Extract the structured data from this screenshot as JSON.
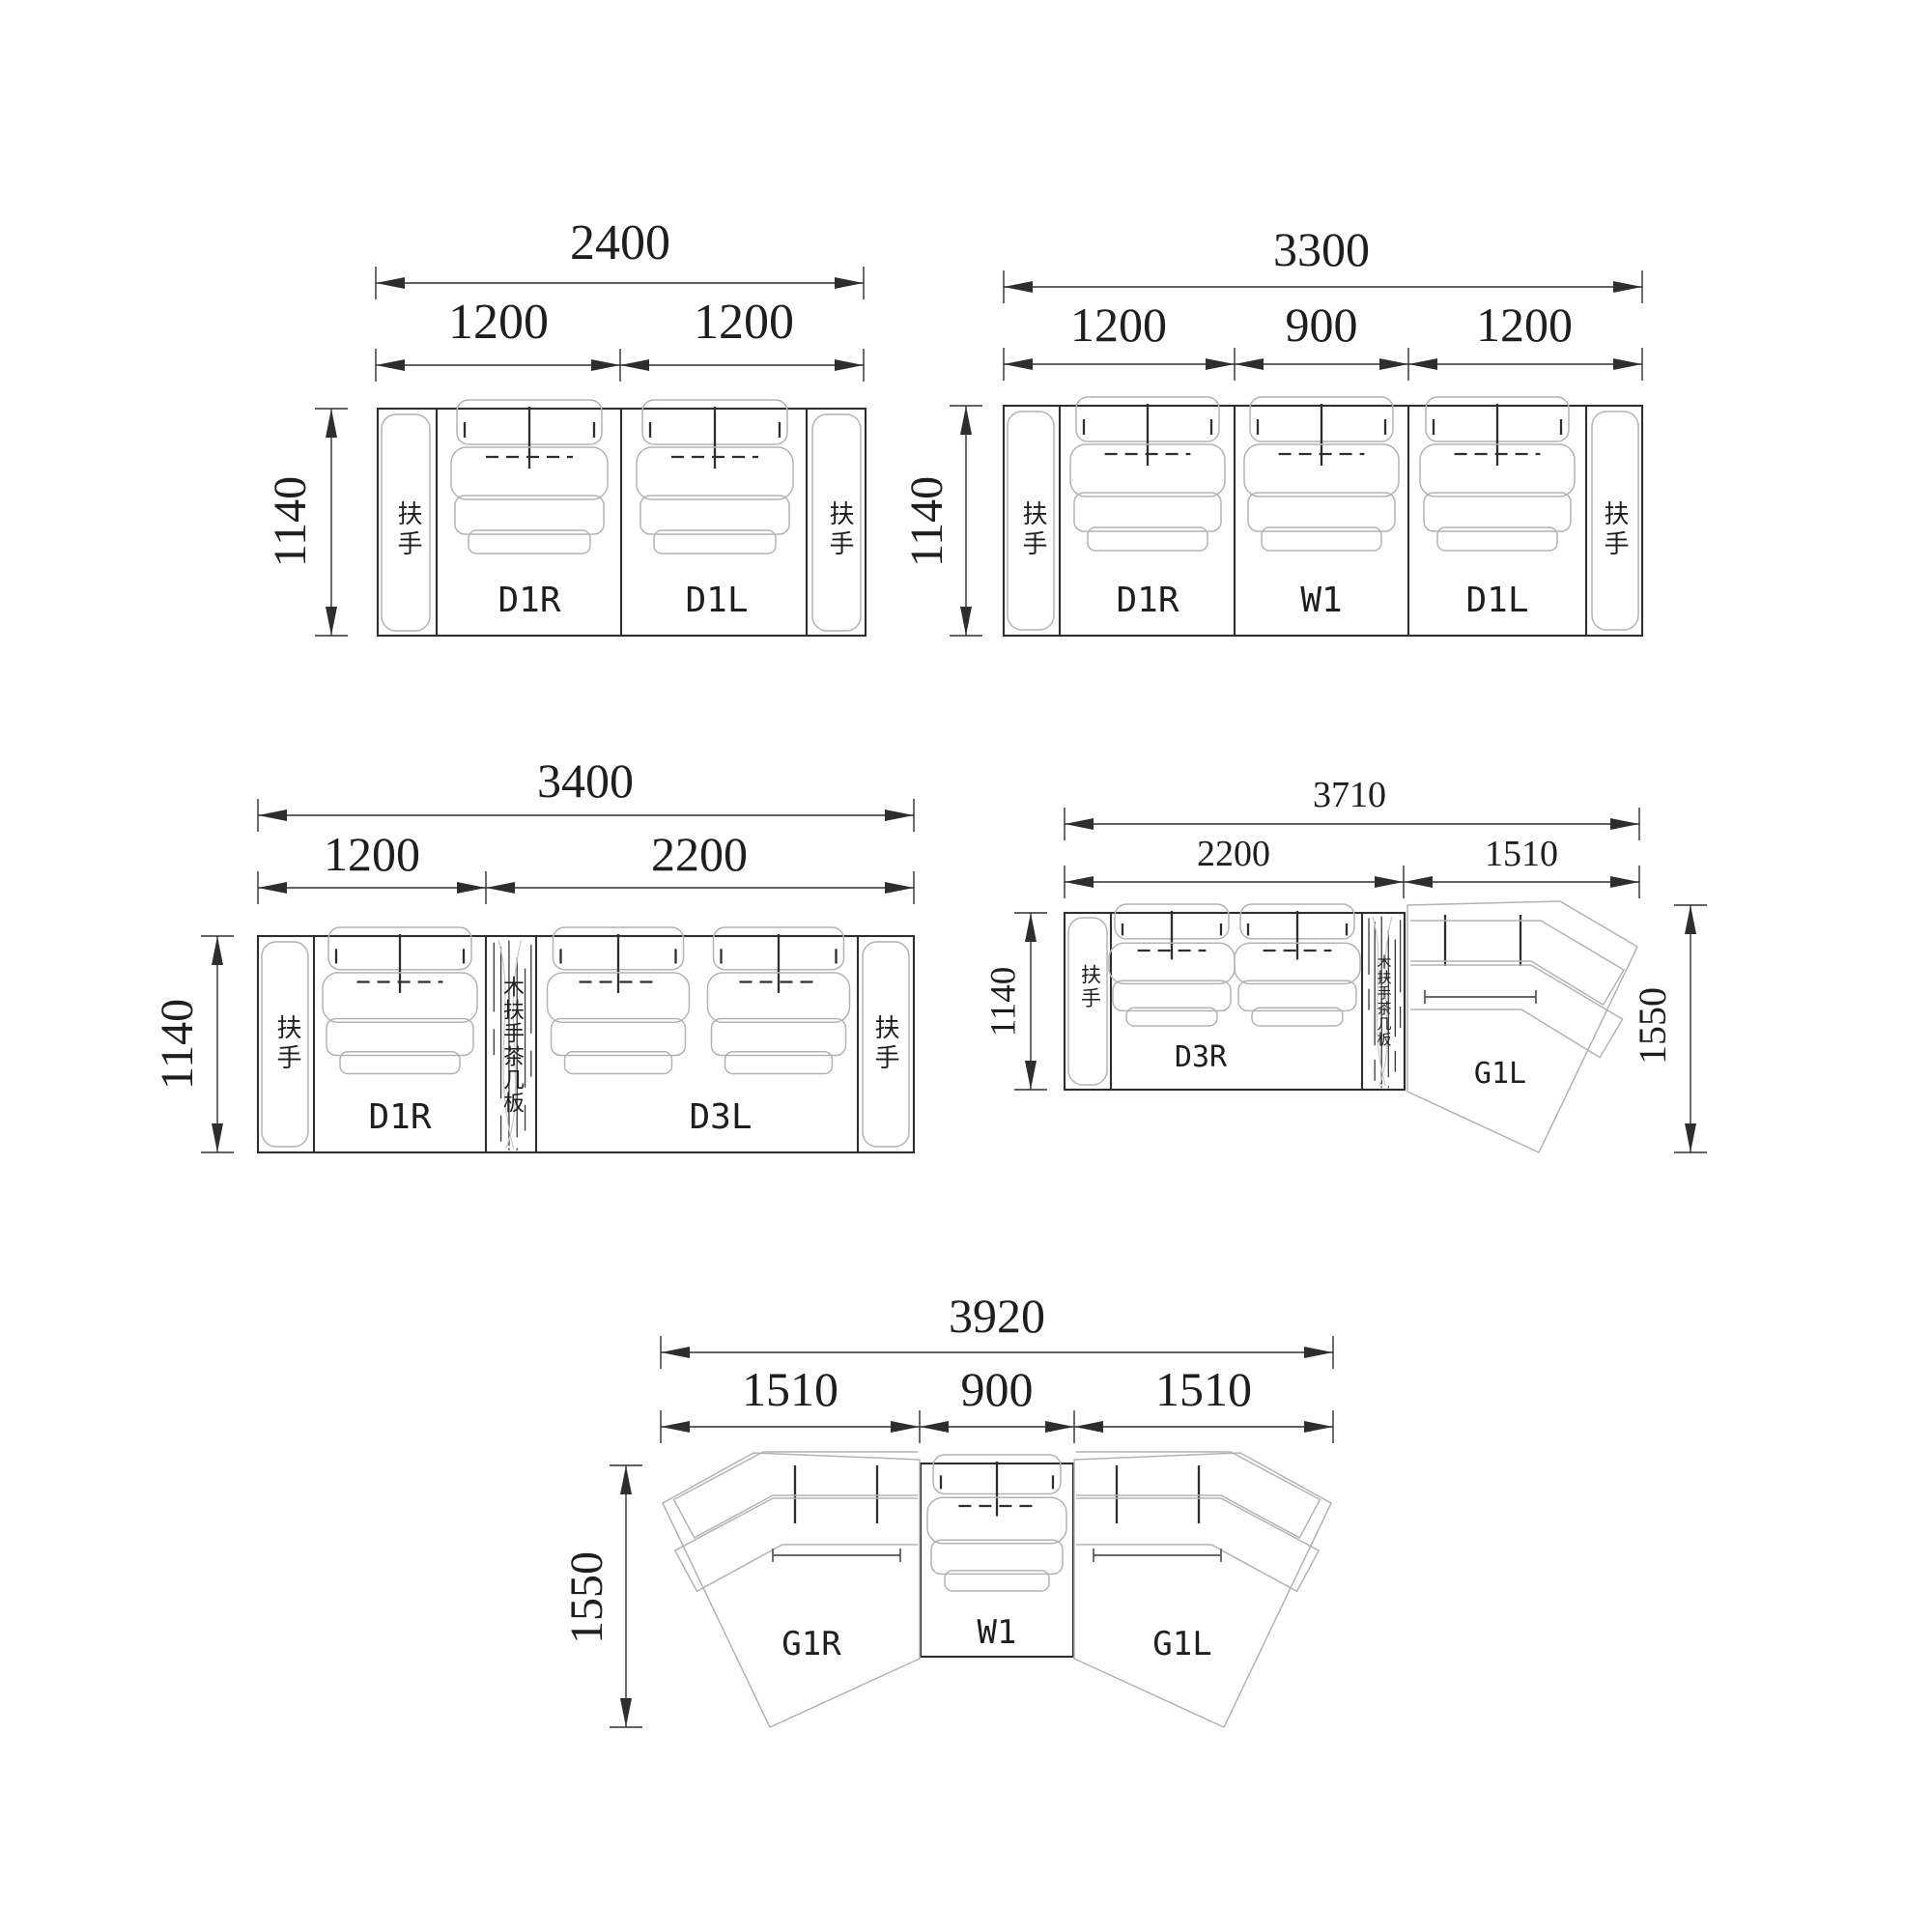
{
  "doc_type": "sofa-configuration-dimension-drawing",
  "units": "mm",
  "diagrams": [
    {
      "id": "config-2400",
      "total": "2400",
      "segments": [
        "1200",
        "1200"
      ],
      "depth": "1140",
      "armrest_left": "扶手",
      "armrest_right": "扶手",
      "modules": [
        "D1R",
        "D1L"
      ]
    },
    {
      "id": "config-3300",
      "total": "3300",
      "segments": [
        "1200",
        "900",
        "1200"
      ],
      "depth": "1140",
      "armrest_left": "扶手",
      "armrest_right": "扶手",
      "modules": [
        "D1R",
        "W1",
        "D1L"
      ]
    },
    {
      "id": "config-3400",
      "total": "3400",
      "segments": [
        "1200",
        "2200"
      ],
      "depth": "1140",
      "armrest_left": "扶手",
      "armrest_right": "扶手",
      "wood_panel": "木扶手茶几板",
      "modules": [
        "D1R",
        "D3L"
      ]
    },
    {
      "id": "config-3710",
      "total": "3710",
      "segments": [
        "2200",
        "1510"
      ],
      "depth": "1140",
      "height": "1550",
      "armrest_left": "扶手",
      "wood_panel": "木扶手茶几板",
      "modules": [
        "D3R",
        "G1L"
      ]
    },
    {
      "id": "config-3920",
      "total": "3920",
      "segments": [
        "1510",
        "900",
        "1510"
      ],
      "height": "1550",
      "modules": [
        "G1R",
        "W1",
        "G1L"
      ]
    }
  ],
  "line_colors": {
    "outline": "#2e2e2e",
    "detail": "#b3b3b3",
    "text": "#1e1e1e"
  }
}
